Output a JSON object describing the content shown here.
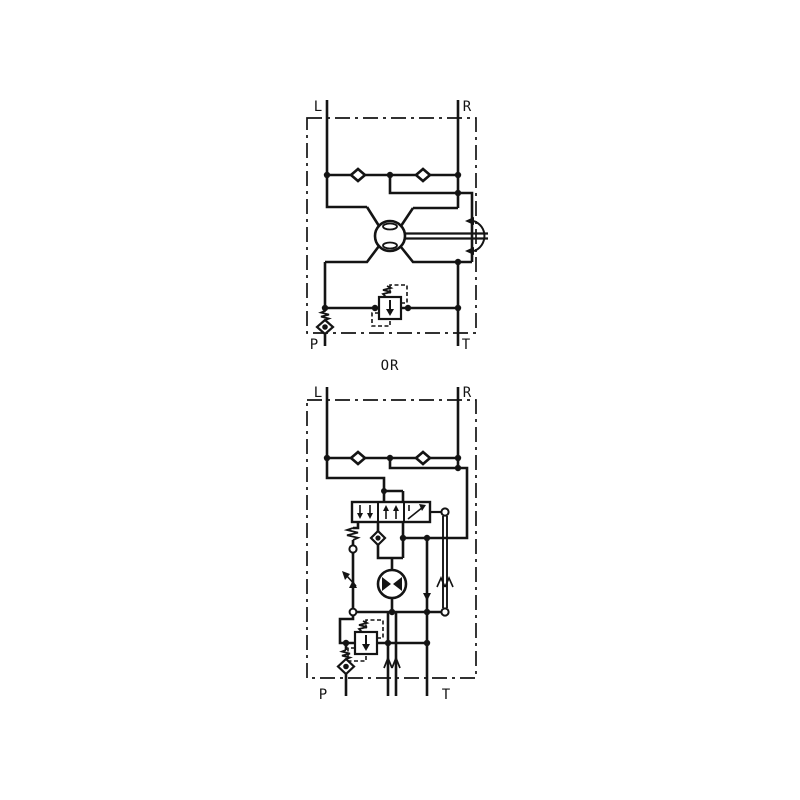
{
  "page": {
    "background": "#ffffff"
  },
  "colors": {
    "line": "#141414",
    "background": "#ffffff"
  },
  "divider": {
    "label": "OR"
  },
  "top_diagram": {
    "title": "steering-unit-simplified-circuit",
    "ports": {
      "left": "L",
      "right": "R",
      "pressure": "P",
      "tank": "T"
    },
    "components": [
      "check-valve-icon",
      "check-valve-icon",
      "steering-metering-unit-icon",
      "steering-wheel-shaft-icon",
      "rotation-arrow-icon",
      "relief-valve-icon",
      "inlet-check-valve-icon",
      "dash-dot-enclosure"
    ]
  },
  "bottom_diagram": {
    "title": "steering-unit-detailed-circuit",
    "ports": {
      "left": "L",
      "right": "R",
      "pressure": "P",
      "tank": "T"
    },
    "components": [
      "check-valve-icon",
      "check-valve-icon",
      "directional-control-valve-icon",
      "centering-spring-icon",
      "feedback-link-icon",
      "metering-motor-icon",
      "relief-valve-icon",
      "inlet-check-valve-icon",
      "dash-dot-enclosure"
    ]
  }
}
